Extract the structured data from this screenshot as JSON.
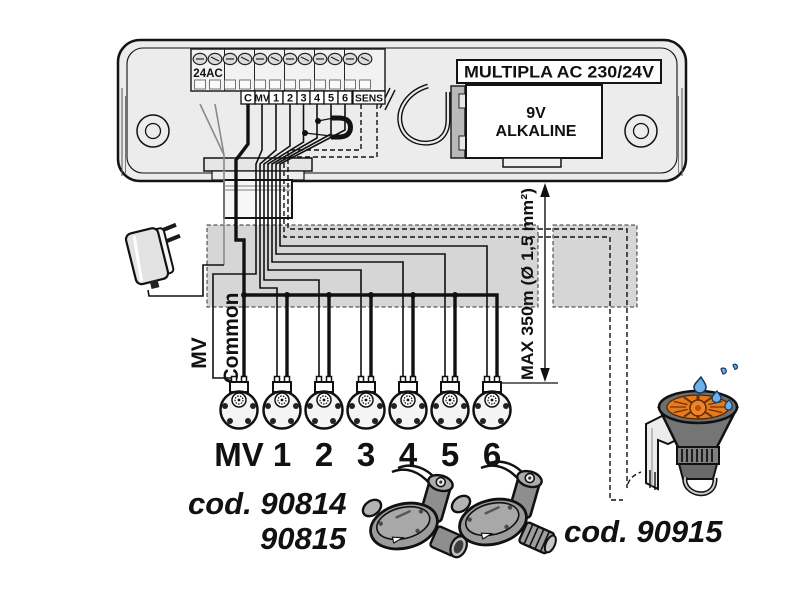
{
  "diagram": {
    "controller": {
      "model_label": "MULTIPLA AC 230/24V",
      "terminal_24ac": "24AC",
      "terminals": [
        "C",
        "MV",
        "1",
        "2",
        "3",
        "4",
        "5",
        "6",
        "SENS"
      ],
      "battery_line1": "9V",
      "battery_line2": "ALKALINE"
    },
    "wiring": {
      "mv_label": "MV",
      "common_label": "Common",
      "max_length_label": "MAX 350m (Ø 1,5 mm²)"
    },
    "valves": {
      "labels": [
        "MV",
        "1",
        "2",
        "3",
        "4",
        "5",
        "6"
      ]
    },
    "products": {
      "valve_code_line1": "cod. 90814",
      "valve_code_line2": "90815",
      "sensor_code": "cod. 90915"
    },
    "colors": {
      "controller_gray": "#ececec",
      "band_gray": "#d6d6d6",
      "accent_orange": "#e87a1e",
      "drop_blue": "#6db1ea",
      "wire_black": "#111111"
    }
  }
}
